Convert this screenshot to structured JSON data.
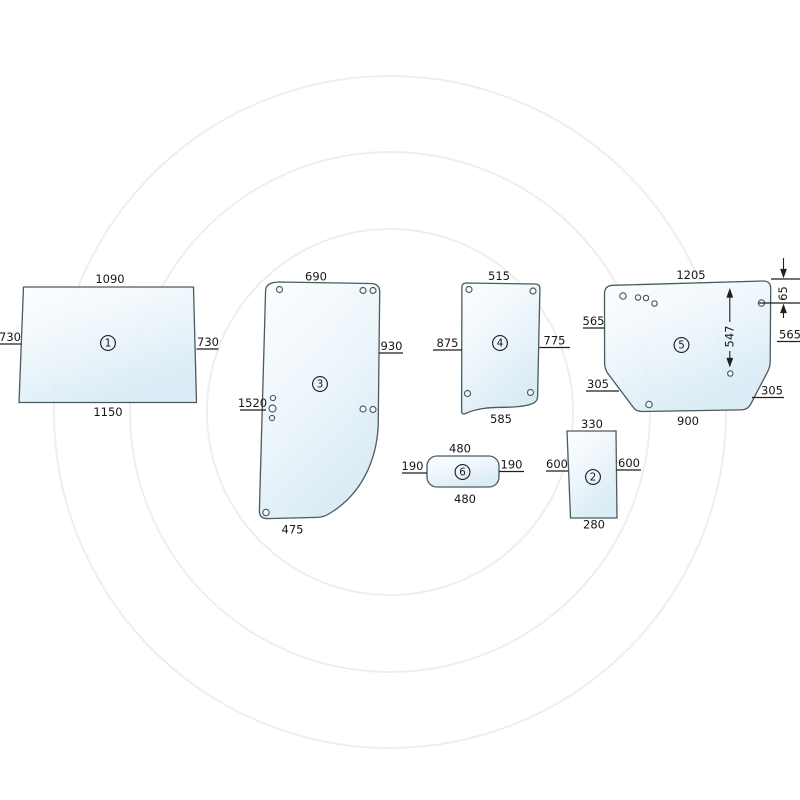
{
  "diagram": {
    "kind": "glass-panel-dimension-diagram",
    "units_implied": "mm",
    "panels": {
      "p1": {
        "num": "1",
        "dim_top": "1090",
        "dim_left": "730",
        "dim_right": "730",
        "dim_bottom": "1150"
      },
      "p2": {
        "num": "2",
        "dim_top": "330",
        "dim_left": "600",
        "dim_right": "600",
        "dim_bottom": "280"
      },
      "p3": {
        "num": "3",
        "dim_top": "690",
        "dim_left": "1520",
        "dim_right": "930",
        "dim_bottom": "475"
      },
      "p4": {
        "num": "4",
        "dim_top": "515",
        "dim_left": "875",
        "dim_right": "775",
        "dim_bottom": "585"
      },
      "p5": {
        "num": "5",
        "dim_top": "1205",
        "dim_left": "565",
        "dim_right": "565",
        "dim_left_lower": "305",
        "dim_right_lower": "305",
        "dim_bottom": "900",
        "dim_hole_span": "547",
        "dim_hole_offset": "65"
      },
      "p6": {
        "num": "6",
        "dim_top": "480",
        "dim_left": "190",
        "dim_right": "190",
        "dim_bottom": "480"
      }
    },
    "colors": {
      "glass_light": "#fbfdfe",
      "glass_dark": "#d5e9f4",
      "outline": "#4a5a61",
      "dimension_text": "#161616",
      "watermark": "#eeeeee"
    }
  }
}
